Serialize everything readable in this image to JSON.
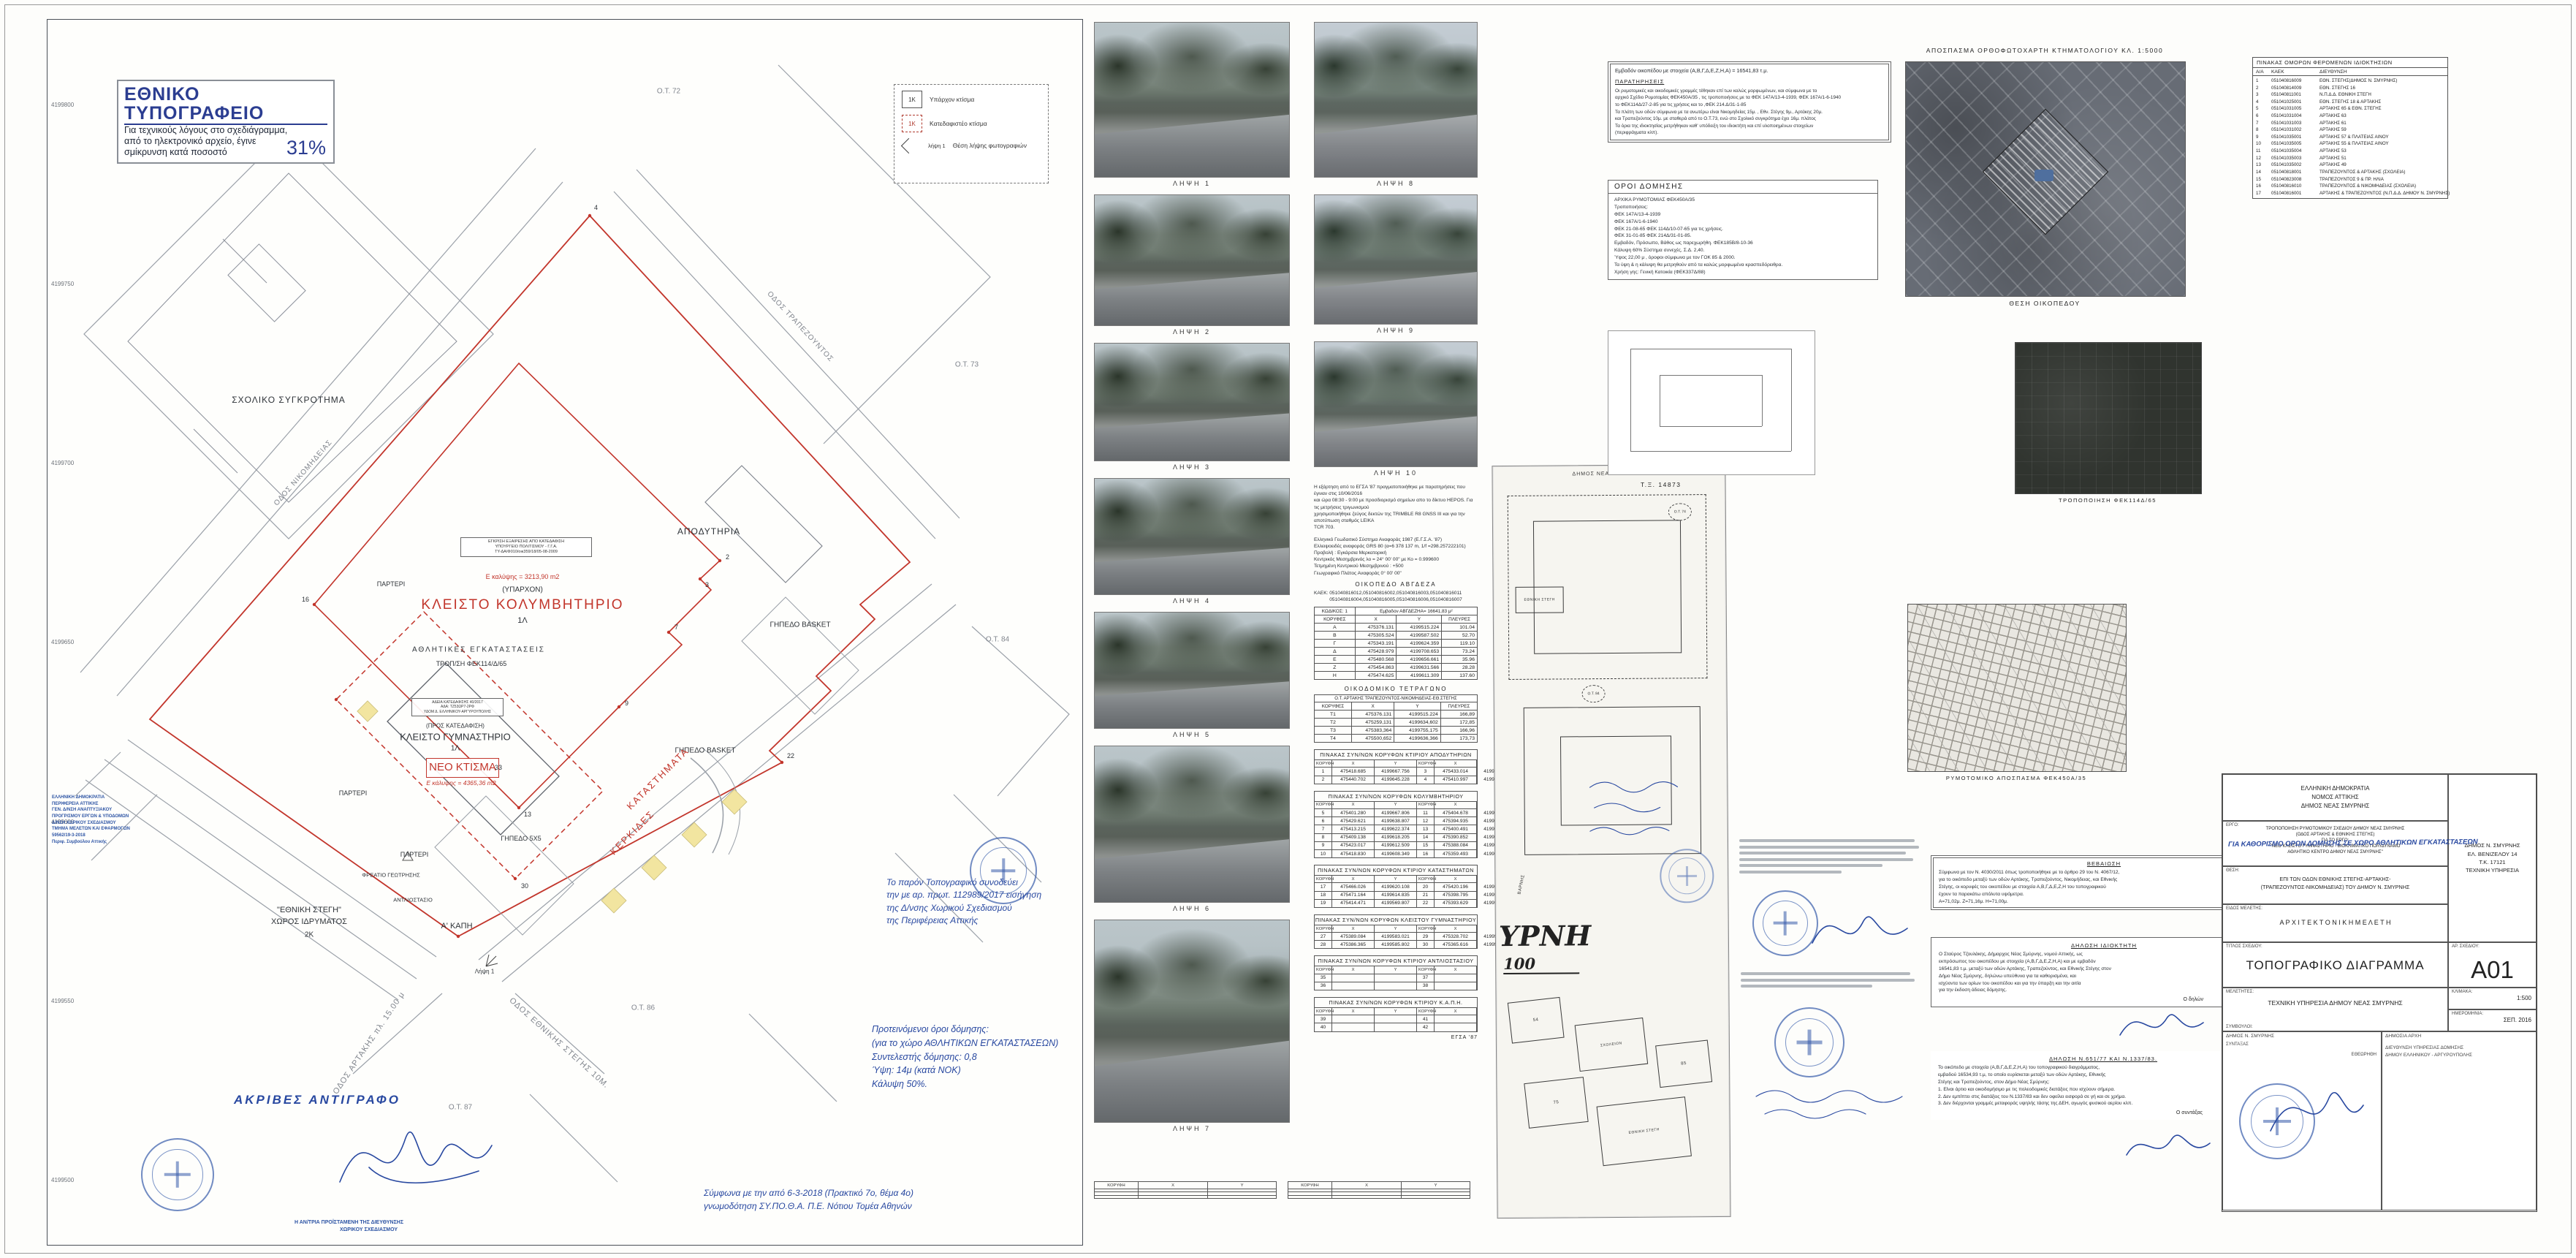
{
  "notice": {
    "title": "ΕΘΝΙΚΟ ΤΥΠΟΓΡΑΦΕΙΟ",
    "line1": "Για τεχνικούς λόγους στο σχεδιάγραμμα,",
    "line2": "από το ηλεκτρονικό αρχείο, έγινε",
    "line3": "σμίκρυνση κατά ποσοστό",
    "percent": "31%"
  },
  "legend": {
    "existing_box": "1Κ",
    "existing_label": "Υπάρχον κτίσμα",
    "demolish_box": "1Κ",
    "demolish_label": "Κατεδαφιστέο κτίσμα",
    "photo_symbol": "λήψη 1",
    "photo_label": "Θέση λήψης φωτογραφιών"
  },
  "map": {
    "grid_labels": [
      "4199800",
      "4199750",
      "4199700",
      "4199650",
      "4199600",
      "4199550",
      "4199500"
    ],
    "ot": {
      "ot72": "Ο.Τ. 72",
      "ot73": "Ο.Τ. 73",
      "ot84": "Ο.Τ. 84",
      "ot86": "Ο.Τ. 86",
      "ot87": "Ο.Τ. 87"
    },
    "labels": {
      "school": "ΣΧΟΛΙΚΟ ΣΥΓΚΡΟΤΗΜΑ",
      "apodytiria": "ΑΠΟΔΥΤΗΡΙΑ",
      "approval1": "ΕΓΚΡΙΣΗ ΕΞΑΙΡΕΣΗΣ ΑΠΟ ΚΑΤΕΔΑΦΙΣΗ",
      "approval2": "ΥΠΟΥΡΓΕΙΟ ΠΟΛΙΤΙΣΜΟΥ - Γ.Γ.Α.",
      "approval3": "ΤΥ-ΔΑ/Φ010/οικ359/18/05-08-2009",
      "kol_cover": "Ε καλύψης = 3213,90 m2",
      "yparxon": "(ΥΠΑΡΧΟΝ)",
      "kolymvitirio": "ΚΛΕΙΣΤΟ ΚΟΛΥΜΒΗΤΗΡΙΟ",
      "kol_floor": "1Λ",
      "athlitikes": "ΑΘΛΗΤΙΚΕΣ ΕΓΚΑΤΑΣΤΑΣΕΙΣ",
      "tropfek": "ΤΡΟΠ/ΣΗ ΦΕΚ114/Δ/65",
      "parteri": "ΠΑΡΤΕΡΙ",
      "basket": "ΓΗΠΕΔΟ BASKET",
      "gipedo5x5": "ΓΗΠΕΔΟ 5Χ5",
      "katastimata": "ΚΑΤΑΣΤΗΜΑΤΑ",
      "kerkides": "ΚΕΡΚΙΔΕΣ",
      "adeia1": "ΑΔΕΙΑ ΚΑΤΕΔΑΦΙΣΗΣ 40/2017",
      "adeia2": "ΑΔΑ: ΤΖ53ΩΡ7-2ΡΦ",
      "adeia3": "ΥΔΟΜ Δ. ΕΛΛΗΝΙΚΟΥ-ΑΡΓΥΡΟΥΠΟΛΗΣ",
      "pros_kat": "(ΠΡΟΣ ΚΑΤΕΔΑΦΙΣΗ)",
      "gymnastirio": "ΚΛΕΙΣΤΟ ΓΥΜΝΑΣΤΗΡΙΟ",
      "gym_floor": "1Λ",
      "neo_ktisma": "ΝΕΟ ΚΤΙΣΜΑ",
      "neo_cover": "Ε κάλυψης = 4365,36 m2",
      "ethniki_stegi": "\"ΕΘΝΙΚΗ ΣΤΕΓΗ\"",
      "xoros_idrymatos": "ΧΩΡΟΣ ΙΔΡΥΜΑΤΟΣ",
      "stegi_floor": "2Κ",
      "kapi": "Α' ΚΑΠΗ",
      "antliostasio": "ΑΝΤΛΙΟΣΤΑΣΙΟ",
      "freatio": "ΦΡΕΑΤΙΟ ΓΕΩΤΡΗΣΗΣ",
      "street_artakis": "ΟΔΟΣ ΑΡΤΑΚΗΣ πλ. 15.00 μ",
      "street_stegis": "ΟΔΟΣ ΕΘΝΙΚΗΣ ΣΤΕΓΗΣ 10Μ.",
      "street_trapez": "ΟΔΟΣ ΤΡΑΠΕΖΟΥΝΤΟΣ",
      "street_nikom": "ΟΔΟΣ ΝΙΚΟΜΗΔΕΙΑΣ",
      "lipsi1": "Λήψη 1"
    },
    "vertices": {
      "v2": "2",
      "v3": "3",
      "v4": "4",
      "v7": "7",
      "v9": "9",
      "v13": "13",
      "v16": "16",
      "v22": "22",
      "v30": "30",
      "v33": "33"
    },
    "blue_office_lines": [
      "ΕΛΛΗΝΙΚΗ ΔΗΜΟΚΡΑΤΙΑ",
      "ΠΕΡΙΦΕΡΕΙΑ ΑΤΤΙΚΗΣ",
      "ΓΕΝ. Δ/ΝΣΗ ΑΝΑΠΤΥΞΙΑΚΟΥ",
      "ΠΡΟΓΡ/ΣΜΟΥ ΕΡΓΩΝ & ΥΠΟΔΟΜΩΝ",
      "Δ/ΝΣΗ ΧΩΡΙΚΟΥ ΣΧΕΔΙΑΣΜΟΥ",
      "ΤΜΗΜΑ ΜΕΛΕΤΩΝ ΚΑΙ ΕΦΑΡΜΟΓΩΝ",
      "59562/19-3-2018",
      "Περιφ. Συμβούλου Αττικής"
    ],
    "stamp_copy": "ΑΚΡΙΒΕΣ  ΑΝΤΙΓΡΑΦΟ",
    "stamp_under1": "Η ΑΝ/ΤΡΙΑ ΠΡΟΪΣΤΑΜΕΝΗ ΤΗΣ ΔΙΕΥΘΥΝΣΗΣ",
    "stamp_under2": "ΧΩΡΙΚΟΥ ΣΧΕΔΙΑΣΜΟΥ",
    "note1": [
      "Το παρόν Τοπογραφικό συνοδεύει",
      "την με αρ. πρωτ. 112989/2017 εισήγηση",
      "της Δ/νσης Χωρικού Σχεδιασμού",
      "της Περιφέρειας Αττικής"
    ],
    "note2": [
      "Προτεινόμενοι  όροι  δόμησης:",
      "(για το χώρο ΑΘΛΗΤΙΚΩΝ ΕΓΚΑΤΑΣΤΑΣΕΩΝ)",
      "Συντελεστής δόμησης:  0,8",
      "Ύψη:  14μ  (κατά ΝΟΚ)",
      "Κάλυψη  50%."
    ],
    "note3": [
      "Σύμφωνα με την από 6-3-2018 (Πρακτικό 7ο, θέμα 4ο)",
      "γνωμοδότηση ΣΥ.ΠΟ.Θ.Α.  Π.Ε. Νότιου Τομέα Αθηνών"
    ]
  },
  "photos_left": [
    {
      "label": "ΛΗΨΗ 1"
    },
    {
      "label": "ΛΗΨΗ 2"
    },
    {
      "label": "ΛΗΨΗ 3"
    },
    {
      "label": "ΛΗΨΗ 4"
    },
    {
      "label": "ΛΗΨΗ 5"
    },
    {
      "label": "ΛΗΨΗ 6"
    },
    {
      "label": "ΛΗΨΗ 7"
    }
  ],
  "photos_right": [
    {
      "label": "ΛΗΨΗ 8"
    },
    {
      "label": "ΛΗΨΗ 9"
    },
    {
      "label": "ΛΗΨΗ 10"
    }
  ],
  "survey": {
    "para": [
      "Η εξάρτηση από το ΕΓΣΑ '87 πραγματοποιήθηκε με παρατηρήσεις που έγιναν στις 10/06/2016",
      "και ώρα 08:30 - 9:00 με προσδιορισμό σημείων απο το δίκτυο HEPOS. Για τις μετρήσεις τριγωνισμού",
      "χρησιμοποιήθηκε ζεύγος δεκτών της TRIMBLE  R8 GNSS  III και για την αποτύπωση σταθμός LEIKA",
      "TCR 703."
    ],
    "datum": [
      "Ελληνικό Γεωδαιτικό Σύστημα Αναφοράς 1987 (Ε.Γ.Σ.Α. '87)",
      "Ελλειψοειδές αναφοράς GRS 80 (α=6 378 137 m, 1/f =298.257222101)",
      "Προβολή : Εγκάρσια Μερκατορική",
      "Κεντρικός Μεσημβρινός λο = 24° 00' 00\" με Κο = 0.999600",
      "Τετμημένη Κεντρικού Μεσημβρινού : +500",
      "Γεωγραφικό Πλάτος Αναφοράς 0° 00' 00\""
    ],
    "parcel_title": "ΟΙΚΟΠΕΔΟ    ΑΒΓΔΕΖΑ",
    "kaek1": "ΚΑΕΚ:  051040816012,051040816002,051040816003,051040816011",
    "kaek2": "051040816004,051040816005,051040816006,051040816007"
  },
  "tables": {
    "parcel": {
      "code": "ΚΩΔΙΚΟΣ: 1",
      "area": "Εμβαδον ΑΒΓΔΕΖΗΑ= 16641,83 μ²",
      "headers": [
        "ΚΟΡΥΦΕΣ",
        "X",
        "Y",
        "ΠΛΕΥΡΕΣ"
      ],
      "rows": [
        [
          "Α",
          "475376.131",
          "4199515.224",
          "101.04"
        ],
        [
          "Β",
          "475305.524",
          "4199587.502",
          "52.70"
        ],
        [
          "Γ",
          "475343.191",
          "4199624.359",
          "119.10"
        ],
        [
          "Δ",
          "475428.979",
          "4199708.653",
          "73.24"
        ],
        [
          "Ε",
          "475480.568",
          "4199656.661",
          "35.96"
        ],
        [
          "Ζ",
          "475454.863",
          "4199631.566",
          "28.28"
        ],
        [
          "Η",
          "475474.625",
          "4199611.309",
          "137.60"
        ]
      ]
    },
    "block_title": "ΟΙΚΟΔΟΜΙΚΟ ΤΕΤΡΑΓΩΝΟ",
    "block": {
      "subtitle": "Ο.Τ. ΑΡΤΑΚΗΣ ΤΡΑΠΕΖΟΥΝΤΟΣ-ΝΙΚΟΜΗΔΕΙΑΣ-ΕΘ.ΣΤΕΓΗΣ",
      "headers": [
        "ΚΟΡΥΦΕΣ",
        "X",
        "Y",
        "ΠΛΕΥΡΕΣ"
      ],
      "rows": [
        [
          "Τ1",
          "475376.131",
          "4199515.224",
          "166,89"
        ],
        [
          "Τ2",
          "475259,131",
          "4199634,602",
          "172,85"
        ],
        [
          "Τ3",
          "475383,364",
          "4199755,175",
          "166,96"
        ],
        [
          "Τ4",
          "475500,652",
          "4199636,366",
          "173,73"
        ]
      ]
    },
    "vertex_tables": [
      {
        "title": "ΠΙΝΑΚΑΣ ΣΥΝ/ΝΩΝ ΚΟΡΥΦΩΝ ΚΤΙΡΙΟΥ ΑΠΟΔΥΤΗΡΙΩΝ",
        "headers": [
          "ΚΟΡΥΦΗ",
          "X",
          "Y",
          "ΚΟΡΥΦΗ",
          "X",
          "Y"
        ],
        "rows": [
          [
            "1",
            "475418.685",
            "4199667.756",
            "3",
            "475433.014",
            "4199637.714"
          ],
          [
            "2",
            "475440.702",
            "4199645.228",
            "4",
            "475410.997",
            "4199660.243"
          ]
        ]
      },
      {
        "title": "ΠΙΝΑΚΑΣ ΣΥΝ/ΝΩΝ ΚΟΡΥΦΩΝ ΚΟΛΥΜΒΗΤΗΡΙΟΥ",
        "headers": [
          "ΚΟΡΥΦΗ",
          "X",
          "Y",
          "ΚΟΡΥΦΗ",
          "X",
          "Y"
        ],
        "rows": [
          [
            "5",
            "475401.280",
            "4199667.806",
            "11",
            "475404.678",
            "4199594.540"
          ],
          [
            "6",
            "475429.621",
            "4199638.807",
            "12",
            "475394.935",
            "4199604.346"
          ],
          [
            "7",
            "475413.215",
            "4199622.374",
            "13",
            "475400.491",
            "4199590.380"
          ],
          [
            "8",
            "475409.138",
            "4199618.205",
            "14",
            "475390.852",
            "4199600.234"
          ],
          [
            "9",
            "475423.017",
            "4199612.509",
            "15",
            "475388.084",
            "4199597.678"
          ],
          [
            "10",
            "475418.830",
            "4199608.349",
            "16",
            "475359.493",
            "4199626.968"
          ]
        ]
      },
      {
        "title": "ΠΙΝΑΚΑΣ ΣΥΝ/ΝΩΝ ΚΟΡΥΦΩΝ ΚΤΙΡΙΟΥ ΚΑΤΑΣΤΗΜΑΤΩΝ",
        "headers": [
          "ΚΟΡΥΦΗ",
          "X",
          "Y",
          "ΚΟΡΥΦΗ",
          "X",
          "Y"
        ],
        "rows": [
          [
            "17",
            "475466.026",
            "4199620.108",
            "20",
            "475420.196",
            "4199565.066"
          ],
          [
            "18",
            "475471.164",
            "4199614.835",
            "21",
            "475398.795",
            "4199565.066"
          ],
          [
            "19",
            "475414.471",
            "4199569.807",
            "22",
            "475393.629",
            "4199549.417"
          ]
        ]
      },
      {
        "title": "ΠΙΝΑΚΑΣ ΣΥΝ/ΝΩΝ ΚΟΡΥΦΩΝ ΚΛΕΙΣΤΟΥ ΓΥΜΝΑΣΤΗΡΙΟΥ",
        "headers": [
          "ΚΟΡΥΦΗ",
          "X",
          "Y",
          "ΚΟΡΥΦΗ",
          "X",
          "Y"
        ],
        "rows": [
          [
            "27",
            "475389.084",
            "4199583.021",
            "29",
            "475328.702",
            "4199597.748"
          ],
          [
            "28",
            "475386.365",
            "4199585.802",
            "30",
            "475365.616",
            "4199559.799"
          ]
        ]
      },
      {
        "title": "ΠΙΝΑΚΑΣ ΣΥΝ/ΝΩΝ ΚΟΡΥΦΩΝ ΚΤΙΡΙΟΥ ΑΝΤΛΙΟΣΤΑΣΙΟΥ",
        "headers": [
          "ΚΟΡΥΦΗ",
          "X",
          "Y",
          "ΚΟΡΥΦΗ",
          "X",
          "Y"
        ],
        "rows": [
          [
            "35",
            "",
            "",
            "37",
            "",
            ""
          ],
          [
            "36",
            "",
            "",
            "38",
            "",
            ""
          ]
        ]
      },
      {
        "title": "ΠΙΝΑΚΑΣ ΣΥΝ/ΝΩΝ ΚΟΡΥΦΩΝ ΚΤΙΡΙΟΥ Κ.Α.Π.Η.",
        "headers": [
          "ΚΟΡΥΦΗ",
          "X",
          "Y",
          "ΚΟΡΥΦΗ",
          "X",
          "Y"
        ],
        "rows": [
          [
            "39",
            "",
            "",
            "41",
            "",
            ""
          ],
          [
            "40",
            "",
            "",
            "42",
            "",
            ""
          ]
        ]
      }
    ],
    "minis": [
      {
        "headers": [
          "ΚΟΡΥΦΗ",
          "X",
          "Y"
        ],
        "rows": [
          [
            "",
            "",
            ""
          ],
          [
            "",
            "",
            ""
          ],
          [
            "",
            "",
            ""
          ]
        ]
      },
      {
        "headers": [
          "ΚΟΡΥΦΗ",
          "X",
          "Y"
        ],
        "rows": [
          [
            "",
            "",
            ""
          ],
          [
            "",
            "",
            ""
          ],
          [
            "",
            "",
            ""
          ]
        ]
      }
    ],
    "datum_caption": "ΕΓΣΑ '87"
  },
  "scanned_page": {
    "heading": "ΔΗΜΟΣ ΝΕΑΣ ΣΜΥΡΝΗΣ",
    "stegi": "ΕΘΝΙΚΗ ΣΤΕΓΗ",
    "varnis": "ΒΑΡΝΗΣ",
    "ot74": "Ο.Τ. 74",
    "ot84": "Ο.Τ. 84",
    "big": "ΥΡΝΗ",
    "scale": "100",
    "blk54": "54",
    "blk75": "75",
    "blk85": "85",
    "school": "ΣΧΟΛΕΙΟΝ",
    "stegi2": "ΕΘΝΙΚΗ ΣΤΕΓΗ"
  },
  "right_column": {
    "ortho_title": "ΑΠΟΣΠΑΣΜΑ ΟΡΘΟΦΩΤΟΧΑΡΤΗ  ΚΤΗΜΑΤΟΛΟΓΙΟΥ  ΚΛ. 1:5000",
    "ortho_caption": "ΘΕΣΗ ΟΙΚΟΠΕΔΟΥ",
    "fek_caption": "ΤΡΟΠΟΠΟΙΗΣΗ ΦΕΚ114Δ/65",
    "rymo_caption": "ΡΥΜΟΤΟΜΙΚΟ ΑΠΟΣΠΑΣΜΑ ΦΕΚ450Α/35",
    "tx_label": "Τ.Ξ.  14873",
    "paratiriseis": {
      "area_line": "Εμβαδόν οικοπέδου με στοιχεία (Α,Β,Γ,Δ,Ε,Ζ,Η,Α) = 16541,83 τ.μ.",
      "title": "ΠΑΡΑΤΗΡΗΣΕΙΣ",
      "lines": [
        "Οι ρυμοτομικές και οικοδομικές γραμμές τέθηκαν επί των καλώς μορφωμένων, και σύμφωνα με το",
        "αρχικό Σχέδιο Ρυμοτομίας ΦΕΚ450Α/35 , τις τροποποιήσεις με τα ΦΕΚ 147Α/13-4-1939, ΦΕΚ 167Α/1-6-1940",
        "το ΦΕΚ114Δ/27-2-85  για τις χρήσεις και το ,ΦΕΚ 214.Δ/31-1-85",
        "Τα πλάτη των οδών σύμφωνα με τα ανωτέρω είναι  Νικομηδείας 15μ. , Εθν. Στέγης 9μ., Αρτάκης 20μ.",
        "και Τραπεζούντος  10μ. με σταθερά από το Ο.Τ.73, ενώ στο Σχολικό συγκρότημα έχει 16μ. πλάτος",
        "Τα όρια της ιδιοκτησίας μετρήθηκαν  καθ' υπόδειξη του ιδιοκτήτη και επί υλοποιημένων στοιχείων",
        "(περιφράγματα κλπ)."
      ]
    },
    "oroi": {
      "title": "ΟΡΟΙ ΔΟΜΗΣΗΣ",
      "lines": [
        "ΑΡΧΙΚΑ ΡΥΜΟΤΟΜΙΑΣ ΦΕΚ450Α/35",
        "Τροποποιήσεις:",
        "ΦΕΚ 147Α/13-4-1939",
        "ΦΕΚ 167Α/1-6-1940",
        "ΦΕΚ 21-08-65  ΦΕΚ 114Δ/10-07-65 για τις χρήσεις.",
        "ΦΕΚ 31-01-85  ΦΕΚ 214Δ/31-01-85.",
        "Εμβαδόν, Πρόσωπο, Βάθος ως παρεχωρήθη. ΦΕΚ185Β/8-10-36",
        "Κάλυψη 60%  Σύστημα συνεχές, Σ.Δ. 2,40.",
        "Ύψος 22,00 μ , όροφοι σύμφωνα με τον ΓΟΚ 85 & 2000.",
        "Τα ύψη & η κάλυψη θα μετρηθούν από τα καλώς μορφωμένα κρασπεδόρειθρα.",
        "Χρήση γης: Γενική Κατοικία (ΦΕΚ337Δ/88)"
      ]
    }
  },
  "adjacent": {
    "title": "ΠΙΝΑΚΑΣ ΟΜΟΡΩΝ ΦΕΡΟΜΕΝΩΝ ΙΔΙΟΚΤΗΣΙΩΝ",
    "headers": [
      "Α/Α",
      "ΚΑΕΚ",
      "ΔΙΕΥΘΥΝΣΗ"
    ],
    "rows": [
      [
        "1",
        "051040816009",
        "ΕΘΝ. ΣΤΕΓΗΣ(ΔΗΜΟΣ Ν. ΣΜΥΡΝΗΣ)"
      ],
      [
        "2",
        "051040814009",
        "ΕΘΝ. ΣΤΕΓΗΣ 16"
      ],
      [
        "3",
        "051040811001",
        "Ν.Π.Δ.Δ. ΕΘΝΙΚΗ ΣΤΕΓΗ"
      ],
      [
        "4",
        "051041025001",
        "ΕΘΝ. ΣΤΕΓΗΣ 18 & ΑΡΤΑΚΗΣ"
      ],
      [
        "5",
        "051041031005",
        "ΑΡΤΑΚΗΣ 65 & ΕΘΝ. ΣΤΕΓΗΣ"
      ],
      [
        "6",
        "051041031004",
        "ΑΡΤΑΚΗΣ 63"
      ],
      [
        "7",
        "051041031003",
        "ΑΡΤΑΚΗΣ 61"
      ],
      [
        "8",
        "051041031002",
        "ΑΡΤΑΚΗΣ 59"
      ],
      [
        "9",
        "051041035001",
        "ΑΡΤΑΚΗΣ 57 & ΠΛΑΤΕΙΑΣ ΑΙΝΟΥ"
      ],
      [
        "10",
        "051041035005",
        "ΑΡΤΑΚΗΣ 55 & ΠΛΑΤΕΙΑΣ ΑΙΝΟΥ"
      ],
      [
        "11",
        "051041035004",
        "ΑΡΤΑΚΗΣ 53"
      ],
      [
        "12",
        "051041035003",
        "ΑΡΤΑΚΗΣ 51"
      ],
      [
        "13",
        "051041035002",
        "ΑΡΤΑΚΗΣ 49"
      ],
      [
        "14",
        "051040818001",
        "ΤΡΑΠΕΖΟΥΝΤΟΣ & ΑΡΤΑΚΗΣ (ΣΧΟΛΕΙΑ)"
      ],
      [
        "15",
        "051040823008",
        "ΤΡΑΠΕΖΟΥΝΤΟΣ 9 & ΠΡ. ΗΛΙΑ"
      ],
      [
        "16",
        "051040816010",
        "ΤΡΑΠΕΖΟΥΝΤΟΣ & ΝΙΚΟΜΗΔΕΙΑΣ  (ΣΧΟΛΕΙΑ)"
      ],
      [
        "17",
        "051040816001",
        "ΑΡΤΑΚΗΣ & ΤΡΑΠΕΖΟΥΝΤΟΣ (Ν.Π.Δ.Δ. ΔΗΜΟΥ Ν. ΣΜΥΡΝΗΣ)"
      ]
    ]
  },
  "blocks": {
    "bebaiosi": {
      "title": "ΒΕΒΑΙΩΣΗ",
      "lines": [
        "Σύμφωνα με τον Ν. 4030/2011 όπως τροποποιήθηκε με το άρθρο 29 του Ν. 4067/12,",
        "για το οικόπεδο μεταξύ των οδών Αρτάκης, Τραπεζούντος, Νικομήδειας, και Εθνικής",
        "Στέγης, οι κορυφές του οικοπέδου με στοιχεία Α,Β,Γ,Δ,Ε,Ζ,Η του τοπογραφικού",
        "έχουν τα παρακάτω απόλυτα υψόμετρα.",
        "Α=71,02μ.   Ζ=71,16μ.   Η=71,00μ."
      ]
    },
    "dilosi": {
      "title": "ΔΗΛΩΣΗ ΙΔΙΟΚΤΗΤΗ",
      "lines": [
        "Ο Σταύρος Τζουλάκης, Δήμαρχος Νέας Σμύρνης,  νομού Αττικής, ως",
        "εκπρόσωπος του οικοπέδου με στοιχεία (Α,Β,Γ,Δ,Ε,Ζ,Η,Α) και με εμβαδόν",
        "16541,83 τ.μ. μεταξύ των οδών Αρτάκης, Τραπεζούντος, και Εθνικής Στέγης στον",
        "Δήμο Νέας Σμύρνης, δηλώνω υπεύθυνα για τα καθορισμένα, και",
        "ισχύοντα των ορίων του οικοπέδου και για την ύπαρξη και την αιτία",
        "για την έκδοση άδειας δόμησης."
      ],
      "sign": "Ο δηλών"
    },
    "ypefthini": {
      "title": "ΔΗΛΩΣΗ Ν.651/77 ΚΑΙ Ν.1337/83.",
      "lines": [
        "Το οικόπεδο με στοιχεία (Α,Β,Γ,Δ,Ε,Ζ,Η,Α) του τοπογραφικού διαγράμματος,",
        "εμβαδού 16534,93 τ.μ, το οποίο ευρίσκεται μεταξύ των οδών Αρτάκης, Εθνικής",
        "Στέγης και Τραπεζούντος, στον Δήμο Νέας Σμύρνης:",
        "1.  Είναι άρτιο και οικοδομήσιμο με τις πολεοδομικές διατάξεις που ισχύουν σήμερα.",
        "2.  Δεν εμπίπτει στις διατάξεις του Ν.1337/83 και δεν οφείλει εισφορά σε γή και σε χρήμα.",
        "3.  Δεν διέρχονται γραμμές μεταφοράς υψηλής τάσης της ΔΕΗ, αγωγός φυσικού αερίου κλπ."
      ],
      "sign": "Ο συντάξας"
    }
  },
  "titleblock": {
    "agency": [
      "ΕΛΛΗΝΙΚΗ ΔΗΜΟΚΡΑΤΙΑ",
      "ΝΟΜΟΣ ΑΤΤΙΚΗΣ",
      "ΔΗΜΟΣ ΝΕΑΣ ΣΜΥΡΝΗΣ"
    ],
    "ergo_label": "ΕΡΓΟ:",
    "ergo": [
      "ΤΡΟΠΟΠΟΙΗΣΗ ΡΥΜΟΤΟΜΙΚΟΥ ΣΧΕΔΙΟΥ ΔΗΜΟΥ ΝΕΑΣ ΣΜΥΡΝΗΣ",
      "(ΟΔΟΣ ΑΡΤΑΚΗΣ & ΕΘΝΙΚΗΣ ΣΤΕΓΗΣ)",
      "ΓΙΑ ΤΟ ΕΡΓΟ:",
      "\"ΝΕΟ ΚΛΕΙΣΤΟ ΓΥΜΝΑΣΤΗΡΙΟ - ΒΙΟΚΛΙΜΑΤΙΚΟ ΠΟΛΥΔΥΝΑΜΟ",
      "ΑΘΛΗΤΙΚΟ ΚΕΝΤΡΟ ΔΗΜΟΥ ΝΕΑΣ ΣΜΥΡΝΗΣ\""
    ],
    "ergo_hand": "ΓΙΑ  ΚΑΘΟΡΙΣΜΟ  ΟΡΩΝ  ΔΟΜΗΣΗΣ  ΣΕ  ΧΩΡΟ  ΑΘΛΗΤΙΚΩΝ  ΕΓΚΑΤΑΣΤΑΣΕΩΝ",
    "owner": [
      "ΔΗΜΟΣ Ν. ΣΜΥΡΝΗΣ",
      "ΕΛ. ΒΕΝΙΖΕΛΟΥ 14",
      "Τ.Κ. 17121",
      "ΤΕΧΝΙΚΗ ΥΠΗΡΕΣΙΑ"
    ],
    "thesi_label": "ΘΕΣΗ:",
    "thesi": [
      "ΕΠΙ ΤΩΝ ΟΔΩΝ ΕΘΝΙΚΗΣ ΣΤΕΓΗΣ-ΑΡΤΑΚΗΣ-",
      "(ΤΡΑΠΕΖΟΥΝΤΟΣ-ΝΙΚΟΜΗΔΕΙΑΣ) ΤΟΥ ΔΗΜΟΥ Ν. ΣΜΥΡΝΗΣ"
    ],
    "eidos_label": "ΕΙΔΟΣ ΜΕΛΕΤΗΣ:",
    "eidos": "Α Ρ Χ Ι Τ Ε Κ Τ Ο Ν Ι Κ Η   Μ Ε Λ Ε Τ Η",
    "titlos_label": "ΤΙΤΛΟΣ ΣΧΕΔΙΟΥ:",
    "titlos": "ΤΟΠΟΓΡΑΦΙΚΟ ΔΙΑΓΡΑΜΜΑ",
    "ar_label": "ΑΡ. ΣΧΕΔΙΟΥ:",
    "ar": "A01",
    "meletites_label": "ΜΕΛΕΤΗΤΕΣ:",
    "meletites": "ΤΕΧΝΙΚΗ ΥΠΗΡΕΣΙΑ ΔΗΜΟΥ ΝΕΑΣ ΣΜΥΡΝΗΣ",
    "symvouloi_label": "ΣΥΜΒΟΥΛΟΙ:",
    "klimaka_label": "ΚΛΙΜΑΚΑ:",
    "klimaka": "1:500",
    "imerominia_label": "ΗΜΕΡΟΜΗΝΙΑ:",
    "imerominia": "ΣΕΠ. 2016",
    "syntaxas_org": "ΔΗΜΟΣ Ν. ΣΜΥΡΝΗΣ",
    "syntaxas": "ΣΥΝΤΑΞΑΣ",
    "etheorithi": "ΕΘΕΩΡΗΘΗ",
    "dimosia_arxi": "ΔΗΜΟΣΙΑ ΑΡΧΗ",
    "ypiresia1": "ΔΙΕΥΘΥΝΣΗ ΥΠΗΡΕΣΙΑΣ ΔΟΜΗΣΗΣ",
    "ypiresia2": "ΔΗΜΟΥ ΕΛΛΗΝΙΚΟΥ - ΑΡΓΥΡΟΥΠΟΛΗΣ"
  }
}
